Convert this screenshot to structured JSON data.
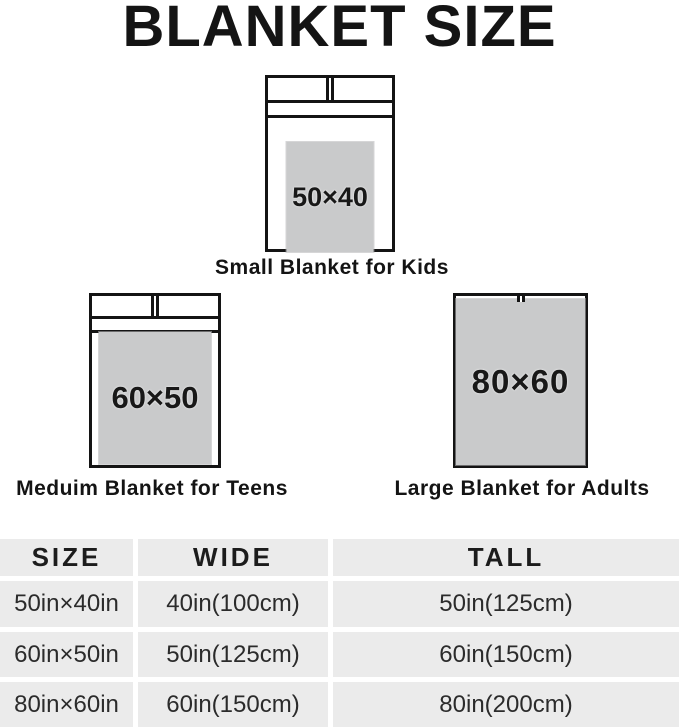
{
  "title": "BLANKET SIZE",
  "diagrams": [
    {
      "id": "small",
      "label": "50×40",
      "caption": "Small Blanket for Kids"
    },
    {
      "id": "medium",
      "label": "60×50",
      "caption": "Meduim Blanket for Teens"
    },
    {
      "id": "large",
      "label": "80×60",
      "caption": "Large Blanket for Adults"
    }
  ],
  "table": {
    "headers": [
      "SIZE",
      "WIDE",
      "TALL"
    ],
    "rows": [
      [
        "50in×40in",
        "40in(100cm)",
        "50in(125cm)"
      ],
      [
        "60in×50in",
        "50in(125cm)",
        "60in(150cm)"
      ],
      [
        "80in×60in",
        "60in(150cm)",
        "80in(200cm)"
      ]
    ]
  },
  "colors": {
    "blanket": "#c9cacb",
    "bed_outline": "#141414",
    "table_cell_bg": "#ebebeb",
    "table_text": "#2b2b2b",
    "text": "#141414",
    "background": "#ffffff"
  }
}
